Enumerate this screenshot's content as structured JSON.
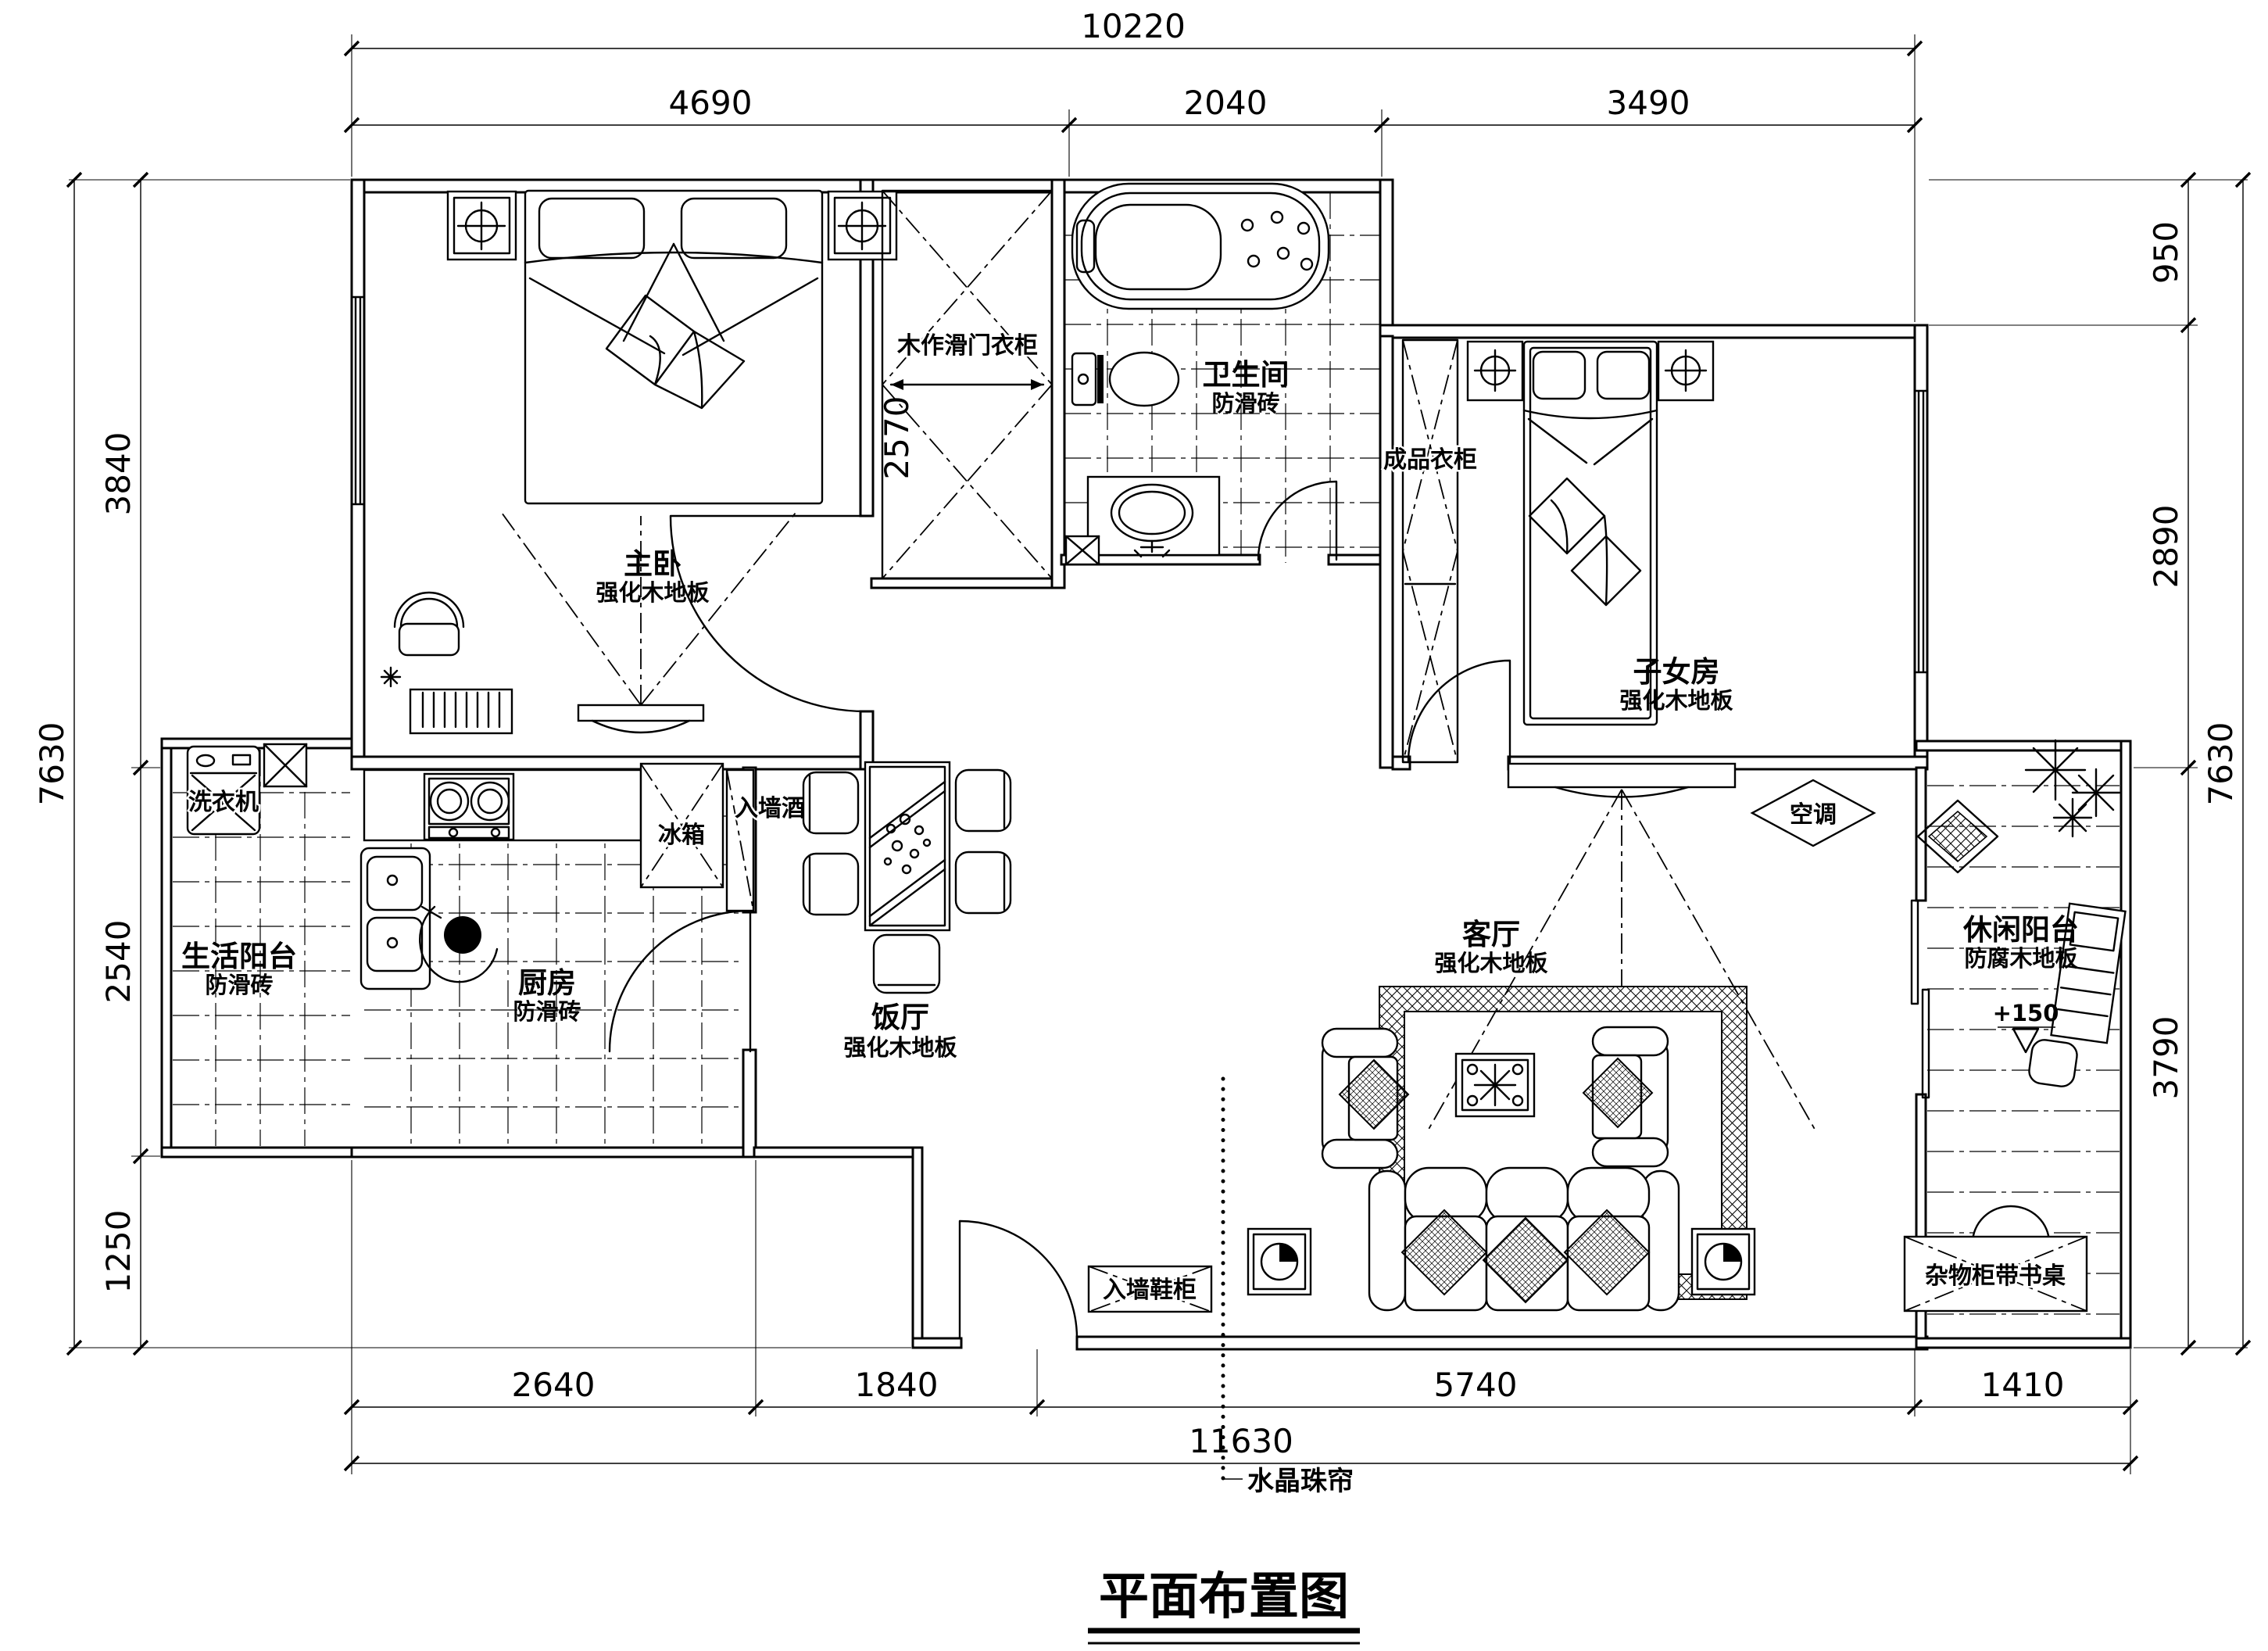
{
  "title": "平面布置图",
  "dims": {
    "top_overall": "10220",
    "top_seg0": "4690",
    "top_seg1": "2040",
    "top_seg2": "3490",
    "right_seg0": "950",
    "right_seg1": "2890",
    "right_seg2": "3790",
    "right_overall": "7630",
    "left_seg0": "3840",
    "left_seg1": "2540",
    "left_seg2": "1250",
    "left_overall": "7630",
    "bottom_seg0": "2640",
    "bottom_seg1": "1840",
    "bottom_seg2": "5740",
    "bottom_seg3": "1410",
    "bottom_overall": "11630",
    "wardrobe_depth": "2570"
  },
  "rooms": {
    "master": {
      "name": "主卧",
      "floor": "强化木地板"
    },
    "bath": {
      "name": "卫生间",
      "floor": "防滑砖"
    },
    "child": {
      "name": "子女房",
      "floor": "强化木地板"
    },
    "kitchen": {
      "name": "厨房",
      "floor": "防滑砖"
    },
    "dining": {
      "name": "饭厅",
      "floor": "强化木地板"
    },
    "living": {
      "name": "客厅",
      "floor": "强化木地板"
    },
    "service_balcony": {
      "name": "生活阳台",
      "floor": "防滑砖"
    },
    "leisure_balcony": {
      "name": "休闲阳台",
      "floor": "防腐木地板",
      "level": "+150"
    }
  },
  "labels": {
    "sliding_wardrobe": "木作滑门衣柜",
    "ready_wardrobe": "成品衣柜",
    "washing_machine": "洗衣机",
    "fridge": "冰箱",
    "wine_rack": "入墙酒架",
    "air_conditioner": "空调",
    "shoe_cabinet": "入墙鞋柜",
    "bead_curtain": "水晶珠帘",
    "storage_desk": "杂物柜带书桌"
  }
}
